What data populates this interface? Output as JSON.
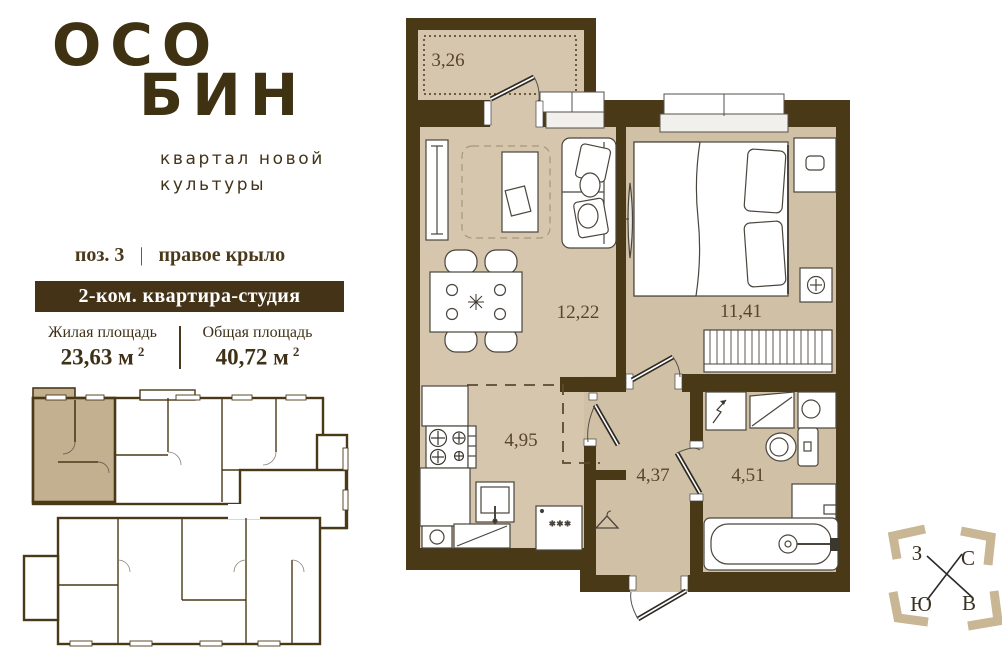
{
  "brand": {
    "primary": "ОСО",
    "secondary": "БИН",
    "tagline_line1": "квартал новой",
    "tagline_line2": "культуры"
  },
  "listing": {
    "position_label": "поз. 3",
    "separator": "|",
    "wing_label": "правое крыло",
    "banner": "2-ком. квартира-студия"
  },
  "areas": {
    "living": {
      "label": "Жилая площадь",
      "value": "23,63 м",
      "sup": "2"
    },
    "total": {
      "label": "Общая площадь",
      "value": "40,72 м",
      "sup": "2"
    }
  },
  "floorplan": {
    "rooms": [
      {
        "id": "balcony",
        "area": "3,26"
      },
      {
        "id": "living-room",
        "area": "12,22"
      },
      {
        "id": "bedroom",
        "area": "11,41"
      },
      {
        "id": "kitchen",
        "area": "4,95"
      },
      {
        "id": "hallway",
        "area": "4,37"
      },
      {
        "id": "bathroom",
        "area": "4,51"
      }
    ],
    "washer_marks": "***"
  },
  "compass": {
    "west": "З",
    "north": "С",
    "south": "Ю",
    "east": "В"
  },
  "colors": {
    "wall": "#4a3917",
    "floor": "#d5c6ad",
    "highlight_unit": "#c3b090",
    "brand_brown": "#3f3213",
    "banner_bg": "#453318",
    "banner_text": "#ffffff",
    "compass_bracket": "#c9b694"
  }
}
